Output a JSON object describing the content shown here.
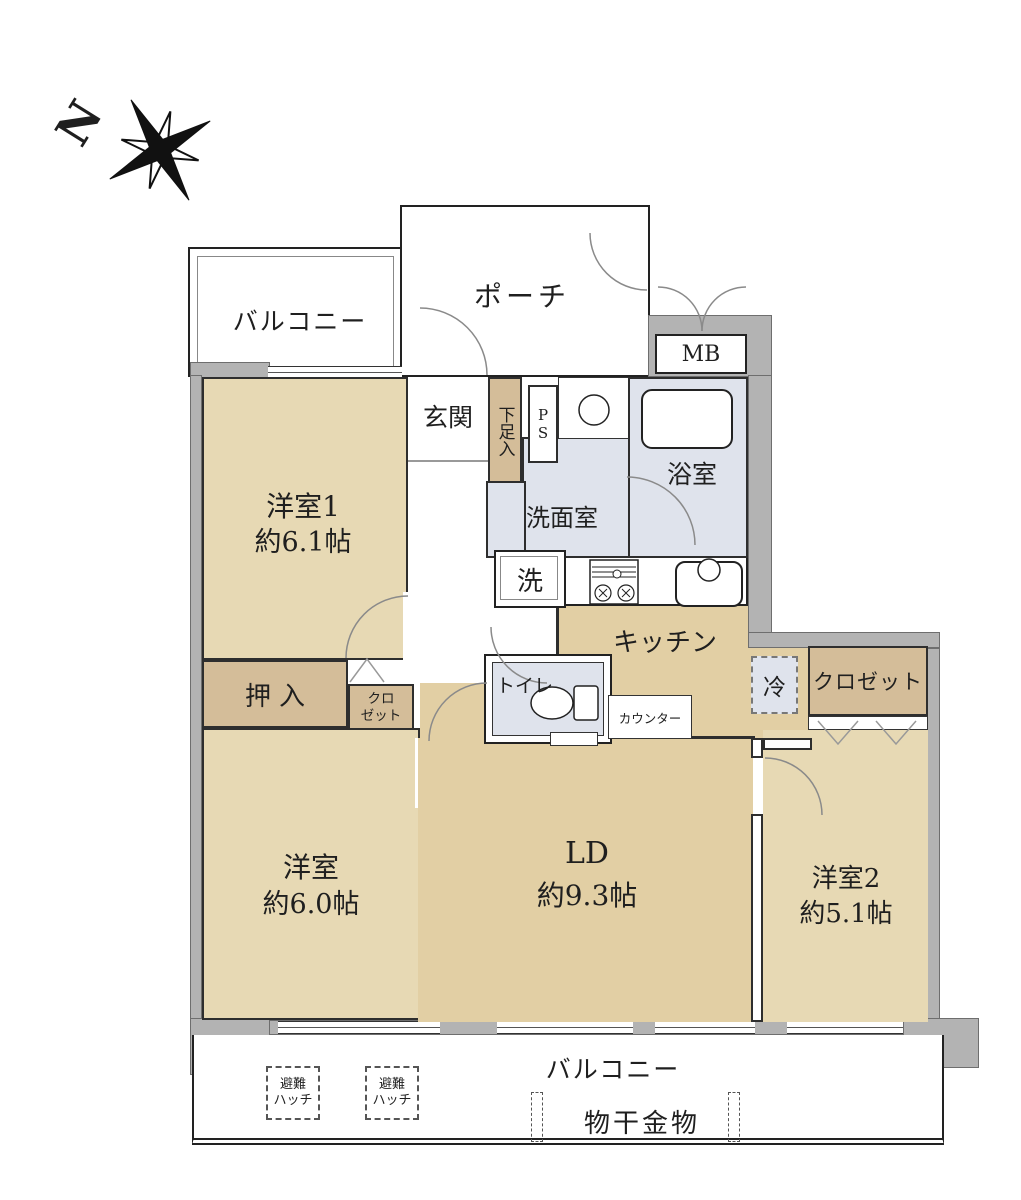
{
  "compass": {
    "north": "N"
  },
  "colors": {
    "room_tan": "#e7d9b4",
    "ld_tan": "#e2cfa4",
    "closet_tan": "#d4bd99",
    "wet_blue": "#dfe3ec",
    "wall_gray": "#b3b3b3",
    "line": "#2e2e2e"
  },
  "plan": {
    "balcony_top": "バルコニー",
    "porch": "ポーチ",
    "meter_box": "MB",
    "entrance": "玄関",
    "shoe_box": "下足入",
    "pipe_space": "PS",
    "washroom": "洗面室",
    "bathroom": "浴室",
    "washer": "洗",
    "kitchen": "キッチン",
    "room1_name": "洋室1",
    "room1_size": "約6.1帖",
    "oshiire": "押入",
    "closet_small_l1": "クロ",
    "closet_small_l2": "ゼット",
    "toilet": "トイレ",
    "counter": "カウンター",
    "fridge": "冷",
    "closet_right": "クロゼット",
    "room_main_name": "洋室",
    "room_main_size": "約6.0帖",
    "ld_name": "LD",
    "ld_size": "約9.3帖",
    "room2_name": "洋室2",
    "room2_size": "約5.1帖",
    "balcony_bottom": "バルコニー",
    "hatch_l1": "避難",
    "hatch_l2": "ハッチ",
    "laundry": "物干金物"
  }
}
